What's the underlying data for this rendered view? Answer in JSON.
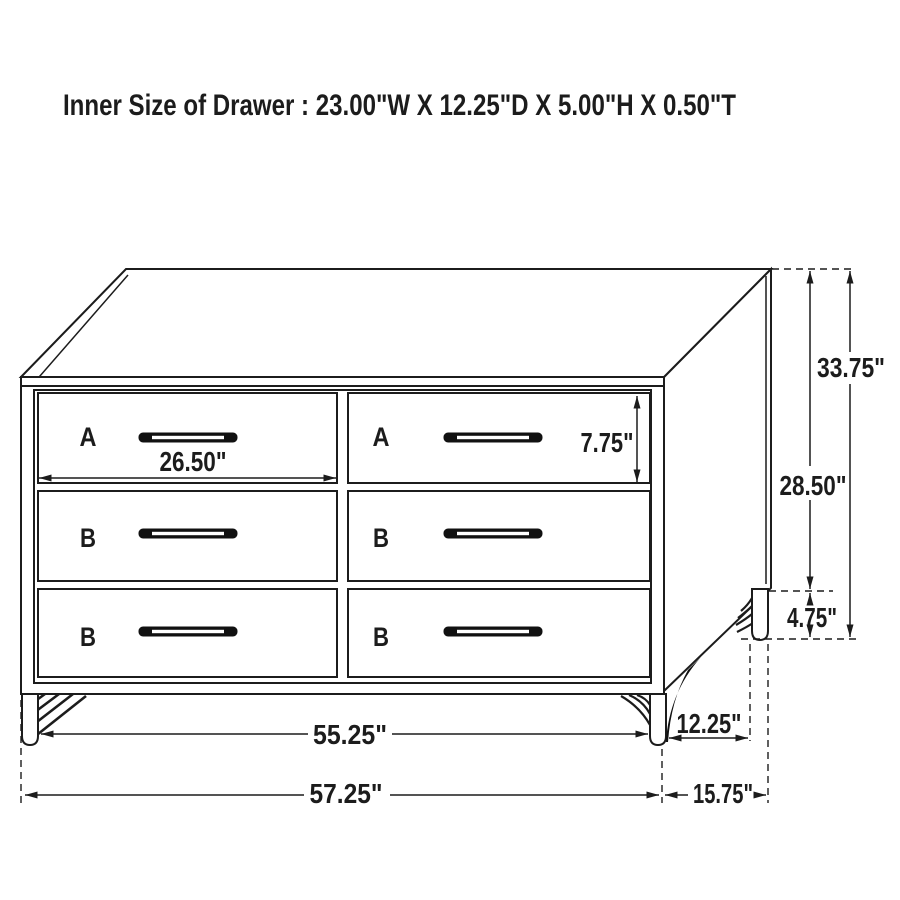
{
  "title": "Inner Size of Drawer : 23.00\"W X 12.25\"D X 5.00\"H X 0.50\"T",
  "colors": {
    "line": "#1c1c1c",
    "drawer_label": "#b22222",
    "background": "#ffffff"
  },
  "drawer_labels": [
    {
      "position": "top-left",
      "label": "A"
    },
    {
      "position": "top-right",
      "label": "A"
    },
    {
      "position": "middle-left",
      "label": "B"
    },
    {
      "position": "middle-right",
      "label": "B"
    },
    {
      "position": "bottom-left",
      "label": "B"
    },
    {
      "position": "bottom-right",
      "label": "B"
    }
  ],
  "dimensions": {
    "drawer_face_width": "26.50\"",
    "drawer_face_height": "7.75\"",
    "overall_height": "33.75\"",
    "case_height": "28.50\"",
    "leg_height": "4.75\"",
    "width_between_legs": "55.25\"",
    "depth_between_legs": "12.25\"",
    "overall_width": "57.25\"",
    "overall_depth": "15.75\""
  }
}
